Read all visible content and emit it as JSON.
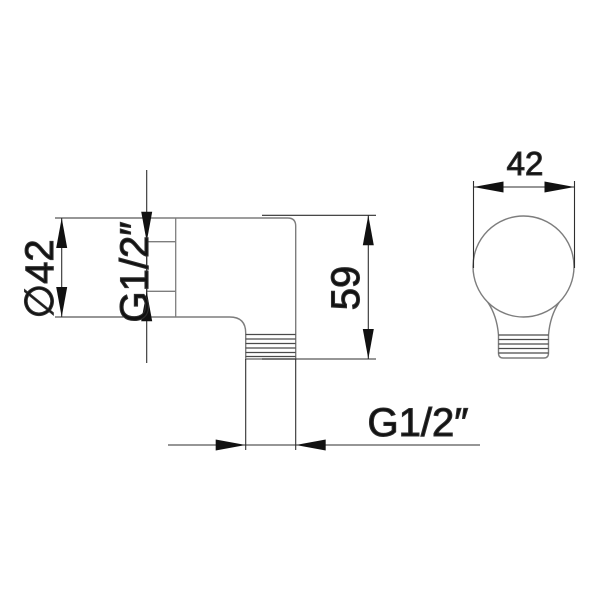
{
  "drawing": {
    "background": "#ffffff",
    "labels": {
      "side_diameter": "∅42",
      "side_thread": "G1/2″",
      "side_height": "59",
      "outlet_thread": "G1/2″",
      "front_width": "42"
    },
    "dimensions_shown": {
      "body_diameter_mm": 42,
      "height_mm": 59,
      "front_width_mm": 42,
      "inlet_thread": "G1/2″",
      "outlet_thread": "G1/2″"
    },
    "colors": {
      "part_outline": "#7d7d7d",
      "part_detail": "#4a4a4a",
      "dimension_lines": "#2e2e2e",
      "text": "#111111"
    }
  }
}
